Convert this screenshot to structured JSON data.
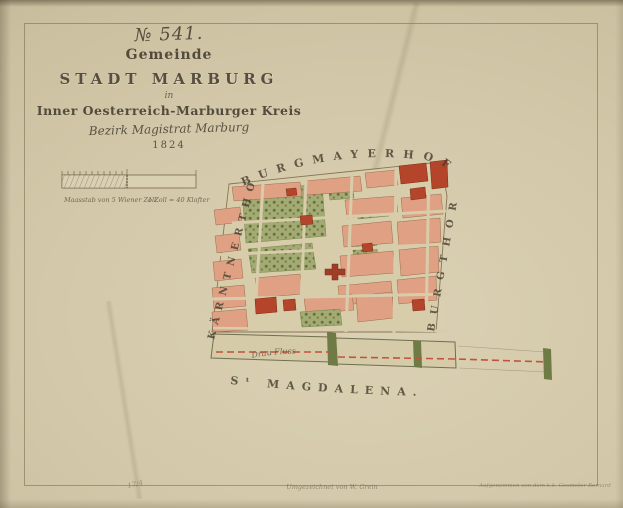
{
  "title_block": {
    "sheet_number": "№ 541.",
    "gemeinde": "Gemeinde",
    "stadt": "STADT MARBURG",
    "in_word": "in",
    "kreis": "Inner Oesterreich-Marburger Kreis",
    "bezirk": "Bezirk Magistrat Marburg",
    "year": "1824"
  },
  "scale_bar": {
    "caption_left": "Maasstab von 5 Wiener Zoll.",
    "caption_right": "1 Zoll = 40 Klafter"
  },
  "map": {
    "labels": {
      "top_edge": "BURGMAYERHOF",
      "left_edge": "KÄRNTNERTHOR",
      "right_edge": "BURGTHOR",
      "bottom_edge": "Sᵗ MAGDALENA.",
      "river": "Drau Fluss"
    },
    "colors": {
      "paper": "#d3c8a9",
      "building": "#dfa084",
      "building_accent": "#b5452a",
      "garden": "#a3aa74",
      "garden_dark": "#66743c",
      "river_dash": "#c2533a"
    }
  },
  "annotations": {
    "bottom_left": "17/4",
    "bottom_center": "Umgezeichnet von W. Grein",
    "bottom_right": "Aufgenommen von dem k.k. Geometer Bernard"
  }
}
